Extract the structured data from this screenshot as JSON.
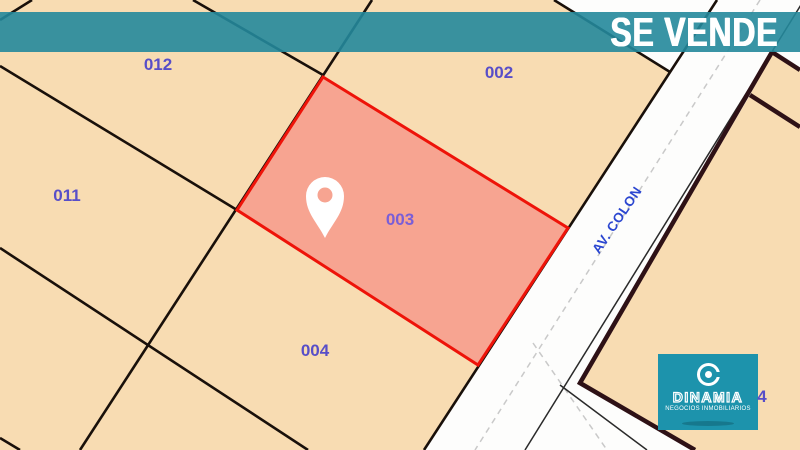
{
  "banner": {
    "label": "SE VENDE",
    "color": "#23889b"
  },
  "map": {
    "background_color": "#fdfdfc",
    "parcel_fill": "#f8dcb2",
    "boundary_color": "#19100a",
    "highlight": {
      "fill": "#f7a491",
      "stroke": "#ee1309"
    },
    "parcels": [
      {
        "id": "012",
        "x": 158,
        "y": 65
      },
      {
        "id": "002",
        "x": 499,
        "y": 73
      },
      {
        "id": "011",
        "x": 67,
        "y": 196
      },
      {
        "id": "003",
        "x": 400,
        "y": 220,
        "highlighted": true
      },
      {
        "id": "004",
        "x": 315,
        "y": 351
      },
      {
        "id": "4",
        "x": 762,
        "y": 397
      }
    ],
    "street": {
      "label": "AV. COLON",
      "x": 617,
      "y": 220,
      "angle_deg": -56,
      "color": "#2b46d0"
    },
    "pin": {
      "x": 325,
      "y": 238
    }
  },
  "logo": {
    "name": "DINAMIA",
    "tagline": "NEGOCIOS INMOBILIARIOS",
    "bg_color": "#1d93ac"
  }
}
